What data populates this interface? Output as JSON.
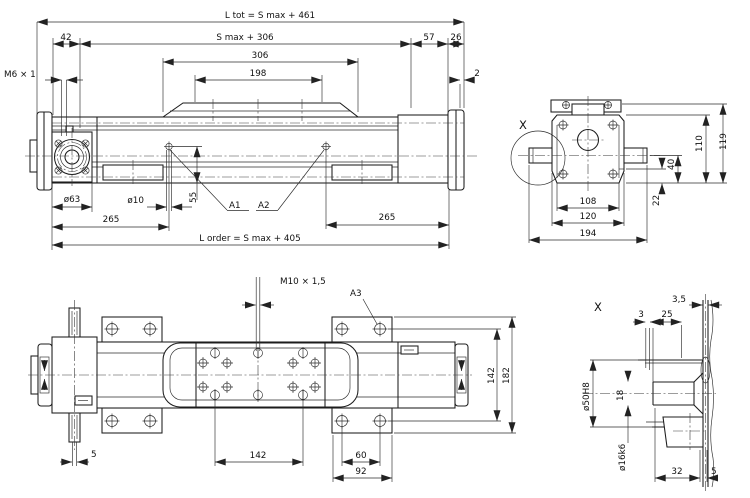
{
  "drawing_type": "technical dimension drawing - linear drive unit",
  "colors": {
    "line": "#1c1c1c",
    "dimension": "#2b2b2b",
    "background": "#ffffff"
  },
  "side_view": {
    "dims": {
      "l_tot": "L tot = S max + 461",
      "s306": "S max + 306",
      "d306": "306",
      "d198": "198",
      "d42": "42",
      "d57": "57",
      "d26": "26",
      "d2": "2",
      "m6": "M6 × 1",
      "dia63": "ø63",
      "dia10": "ø10",
      "d55": "55",
      "d265_left": "265",
      "d265_right": "265",
      "l_order": "L order = S max + 405"
    },
    "labels": {
      "a1": "A1",
      "a2": "A2"
    }
  },
  "end_view": {
    "detail_marker": "X",
    "dims": {
      "d110": "110",
      "d119": "119",
      "d40": "40",
      "d22": "22",
      "d108": "108",
      "d120": "120",
      "d194": "194"
    }
  },
  "top_view": {
    "dims": {
      "m10": "M10 × 1,5",
      "d5": "5",
      "d142_h": "142",
      "d60": "60",
      "d92": "92",
      "d142_v": "142",
      "d182": "182"
    },
    "labels": {
      "a3": "A3"
    }
  },
  "detail_view": {
    "marker": "X",
    "dims": {
      "d3_5": "3,5",
      "d3": "3",
      "d25": "25",
      "dia50": "ø50H8",
      "d18": "18",
      "dia16": "ø16k6",
      "d32": "32",
      "d5": "5"
    }
  }
}
